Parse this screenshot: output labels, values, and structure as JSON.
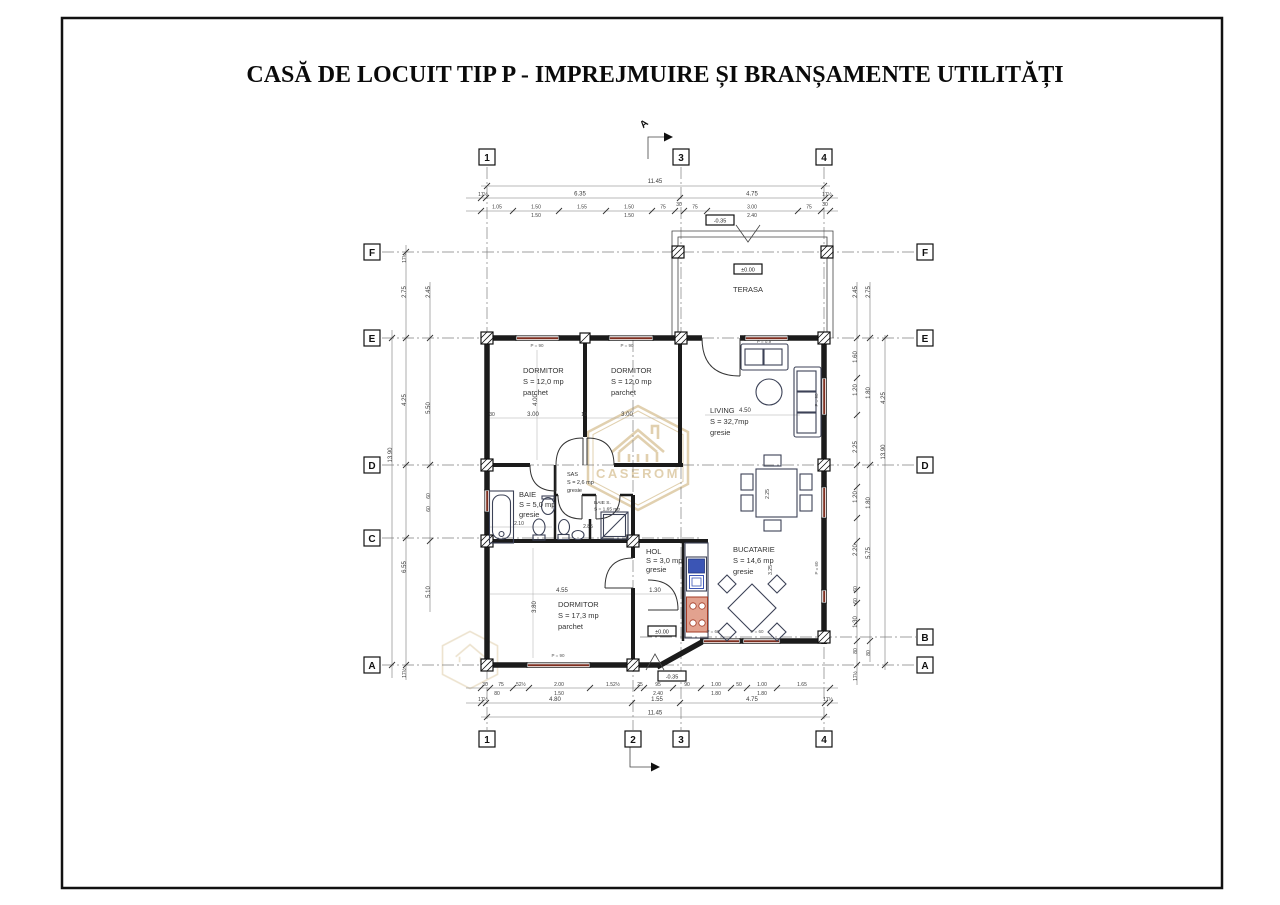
{
  "sheet": {
    "title": "CASĂ DE LOCUIT TIP P - IMPREJMUIRE ȘI BRANȘAMENTE UTILITĂȚI"
  },
  "watermark": {
    "brand": "CASEROM",
    "reg": "®"
  },
  "section": {
    "letter": "A"
  },
  "grid_markers": {
    "top": [
      "1",
      "3",
      "4"
    ],
    "bottom": [
      "1",
      "2",
      "3",
      "4"
    ],
    "left": [
      "F",
      "E",
      "D",
      "C",
      "A"
    ],
    "right": [
      "F",
      "E",
      "D",
      "B",
      "A"
    ]
  },
  "rooms": {
    "terasa": {
      "name": "TERASA"
    },
    "dormitor1": {
      "name": "DORMITOR",
      "area": "S = 12,0 mp",
      "floor": "parchet"
    },
    "dormitor2": {
      "name": "DORMITOR",
      "area": "S = 12,0 mp",
      "floor": "parchet"
    },
    "living": {
      "name": "LIVING",
      "area": "S = 32,7mp",
      "floor": "gresie"
    },
    "baie": {
      "name": "BAIE",
      "area": "S = 5,0 mp",
      "floor": "gresie"
    },
    "sas": {
      "name": "SAS",
      "area": "S = 2,6 mp",
      "floor": "gresie"
    },
    "baie_s": {
      "name": "BAIE S.",
      "area": "S = 1,65 mp"
    },
    "hol": {
      "name": "HOL",
      "area": "S = 3,0 mp",
      "floor": "gresie"
    },
    "dormitor3": {
      "name": "DORMITOR",
      "area": "S = 17,3 mp",
      "floor": "parchet"
    },
    "bucatarie": {
      "name": "BUCATARIE",
      "area": "S = 14,6 mp",
      "floor": "gresie"
    }
  },
  "levels": {
    "terrace_entry": "-0.35",
    "terasa": "±0.00",
    "hol": "±0.00",
    "entry": "-0.35"
  },
  "parapet": {
    "p90": "P = 90",
    "p60": "P = 60",
    "p09": "P = 0.9"
  },
  "dims": {
    "top": {
      "overall": "11.45",
      "row2": [
        "17½",
        "6.35",
        "4.75",
        "17½"
      ],
      "row3": [
        "1.05",
        "1.50",
        "1.55",
        "1.50",
        "75",
        "30",
        "75",
        "3.00",
        "75",
        "30"
      ],
      "row3b": [
        "1.50",
        "1.50",
        "2.40"
      ]
    },
    "bottom": {
      "row1": [
        "30",
        "75",
        "52½",
        "2.00",
        "1.52½",
        "25",
        "95",
        "90",
        "1.00",
        "50",
        "1.00",
        "1.65"
      ],
      "row1b": [
        "80",
        "1.50",
        "2.40",
        "1.80",
        "1.80"
      ],
      "row2": [
        "17½",
        "4.80",
        "1.55",
        "4.75",
        "17½"
      ],
      "overall": "11.45"
    },
    "left": {
      "col1": [
        "17½",
        "2.75",
        "4.25",
        "6.55",
        "17½"
      ],
      "col2": [
        "2.45",
        "5.50",
        "60",
        "60",
        "5.10"
      ],
      "overall": "13.90"
    },
    "right": {
      "col1": [
        "2.45",
        "1.60",
        "1.20",
        "2.25",
        "1.20",
        "2.20",
        "60",
        "60",
        "1.30",
        "80",
        "17½"
      ],
      "col2": [
        "2.75",
        "1.80",
        "1.80",
        "5.75",
        "80"
      ],
      "col3": [
        "4.25",
        "13.90"
      ]
    },
    "interior": {
      "w30": "30",
      "b1w": "3.00",
      "w10": "10",
      "b2w": "3.00",
      "b1h": "4.00",
      "liv": "4.50",
      "baie": "2.10",
      "sbaie": "2.85",
      "d3w": "4.55",
      "hol": "1.30",
      "d3h": "3.80",
      "table": "2.25",
      "kit": "3.25"
    }
  }
}
